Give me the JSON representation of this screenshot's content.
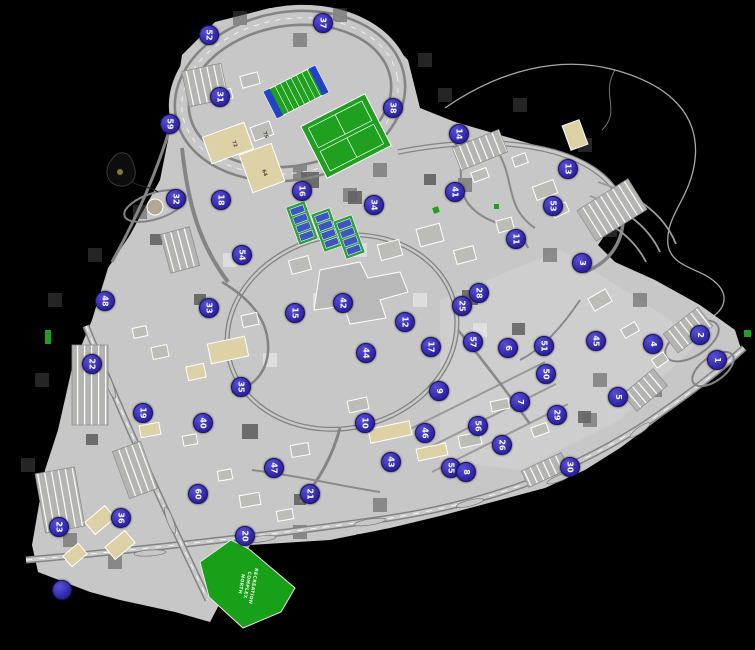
{
  "map": {
    "colors": {
      "background": "#000000",
      "land_gray": "#c7c7c7",
      "road_gray": "#8a8a8a",
      "building_tan": "#ddd2a6",
      "building_gray": "#bdbdb8",
      "field_green": "#1fa01f",
      "endzone_blue": "#2143c8",
      "court_blue": "#3d55c0",
      "marker_blue": "#352bad",
      "marker_text": "#ffffff"
    },
    "recreation_area": {
      "label_lines": [
        "RECREATION",
        "COMPLEX",
        "NORTH"
      ]
    },
    "building_labels": [
      "72",
      "75",
      "64"
    ],
    "markers": [
      {
        "number": "37",
        "x": 323,
        "y": 23
      },
      {
        "number": "52",
        "x": 209,
        "y": 35
      },
      {
        "number": "31",
        "x": 220,
        "y": 97
      },
      {
        "number": "59",
        "x": 170,
        "y": 124
      },
      {
        "number": "38",
        "x": 393,
        "y": 108
      },
      {
        "number": "14",
        "x": 459,
        "y": 134
      },
      {
        "number": "13",
        "x": 568,
        "y": 169
      },
      {
        "number": "41",
        "x": 455,
        "y": 192
      },
      {
        "number": "53",
        "x": 553,
        "y": 206
      },
      {
        "number": "16",
        "x": 302,
        "y": 191
      },
      {
        "number": "34",
        "x": 374,
        "y": 205
      },
      {
        "number": "32",
        "x": 176,
        "y": 199
      },
      {
        "number": "18",
        "x": 221,
        "y": 200
      },
      {
        "number": "11",
        "x": 516,
        "y": 239
      },
      {
        "number": "54",
        "x": 242,
        "y": 255
      },
      {
        "number": "3",
        "x": 582,
        "y": 263
      },
      {
        "number": "28",
        "x": 479,
        "y": 293
      },
      {
        "number": "25",
        "x": 462,
        "y": 306
      },
      {
        "number": "12",
        "x": 405,
        "y": 322
      },
      {
        "number": "42",
        "x": 343,
        "y": 303
      },
      {
        "number": "15",
        "x": 295,
        "y": 313
      },
      {
        "number": "33",
        "x": 209,
        "y": 308
      },
      {
        "number": "48",
        "x": 105,
        "y": 301
      },
      {
        "number": "2",
        "x": 700,
        "y": 335
      },
      {
        "number": "1",
        "x": 717,
        "y": 360
      },
      {
        "number": "4",
        "x": 653,
        "y": 344
      },
      {
        "number": "45",
        "x": 596,
        "y": 341
      },
      {
        "number": "51",
        "x": 544,
        "y": 346
      },
      {
        "number": "6",
        "x": 508,
        "y": 348
      },
      {
        "number": "57",
        "x": 473,
        "y": 342
      },
      {
        "number": "17",
        "x": 431,
        "y": 347
      },
      {
        "number": "44",
        "x": 366,
        "y": 353
      },
      {
        "number": "22",
        "x": 92,
        "y": 364
      },
      {
        "number": "50",
        "x": 546,
        "y": 374
      },
      {
        "number": "5",
        "x": 618,
        "y": 397
      },
      {
        "number": "9",
        "x": 439,
        "y": 391
      },
      {
        "number": "7",
        "x": 520,
        "y": 402
      },
      {
        "number": "29",
        "x": 557,
        "y": 415
      },
      {
        "number": "35",
        "x": 241,
        "y": 387
      },
      {
        "number": "19",
        "x": 143,
        "y": 413
      },
      {
        "number": "40",
        "x": 203,
        "y": 423
      },
      {
        "number": "10",
        "x": 365,
        "y": 423
      },
      {
        "number": "56",
        "x": 478,
        "y": 426
      },
      {
        "number": "46",
        "x": 425,
        "y": 433
      },
      {
        "number": "26",
        "x": 502,
        "y": 445
      },
      {
        "number": "43",
        "x": 391,
        "y": 462
      },
      {
        "number": "55",
        "x": 451,
        "y": 468
      },
      {
        "number": "8",
        "x": 466,
        "y": 472
      },
      {
        "number": "30",
        "x": 570,
        "y": 467
      },
      {
        "number": "47",
        "x": 274,
        "y": 468
      },
      {
        "number": "21",
        "x": 310,
        "y": 494
      },
      {
        "number": "60",
        "x": 198,
        "y": 494
      },
      {
        "number": "36",
        "x": 121,
        "y": 518
      },
      {
        "number": "23",
        "x": 59,
        "y": 527
      },
      {
        "number": "20",
        "x": 245,
        "y": 536
      },
      {
        "number": "",
        "x": 62,
        "y": 590
      }
    ]
  }
}
